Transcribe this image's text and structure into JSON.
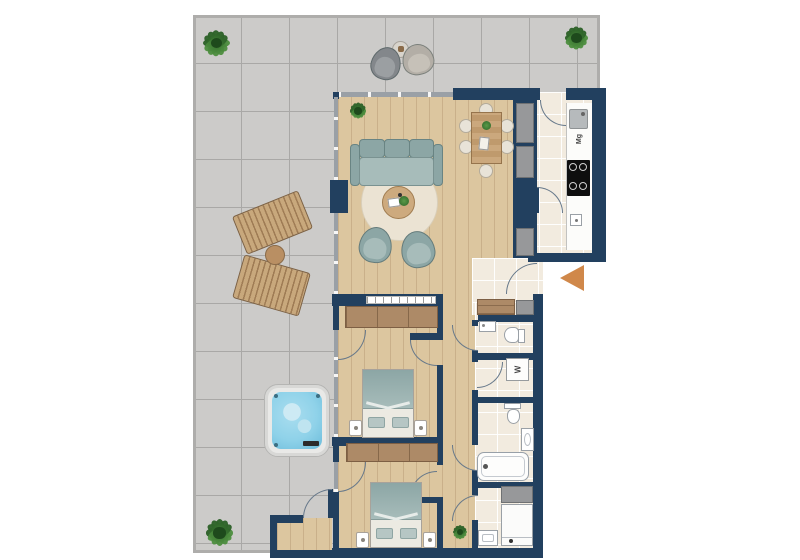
{
  "title": "apartment-floor-plan-with-terrace",
  "labels": {
    "kitchen_appliance": "Mg",
    "washing_machine": "W"
  },
  "colors": {
    "wall": "#22405f",
    "terrace_tile": "#cccbc9",
    "terrace_grout": "#a9a8a6",
    "wood": "#dcc69f",
    "wood_dark": "#ad8a67",
    "bath_tile": "#f2ebdf",
    "upholstery": "#a7bcba",
    "upholstery_dark": "#8ca6a5",
    "rug": "#ebe3d3",
    "water": "#8fd2e9",
    "lounger": "#c8a87c",
    "arrow": "#d0884a",
    "plant": "#4f9140"
  }
}
